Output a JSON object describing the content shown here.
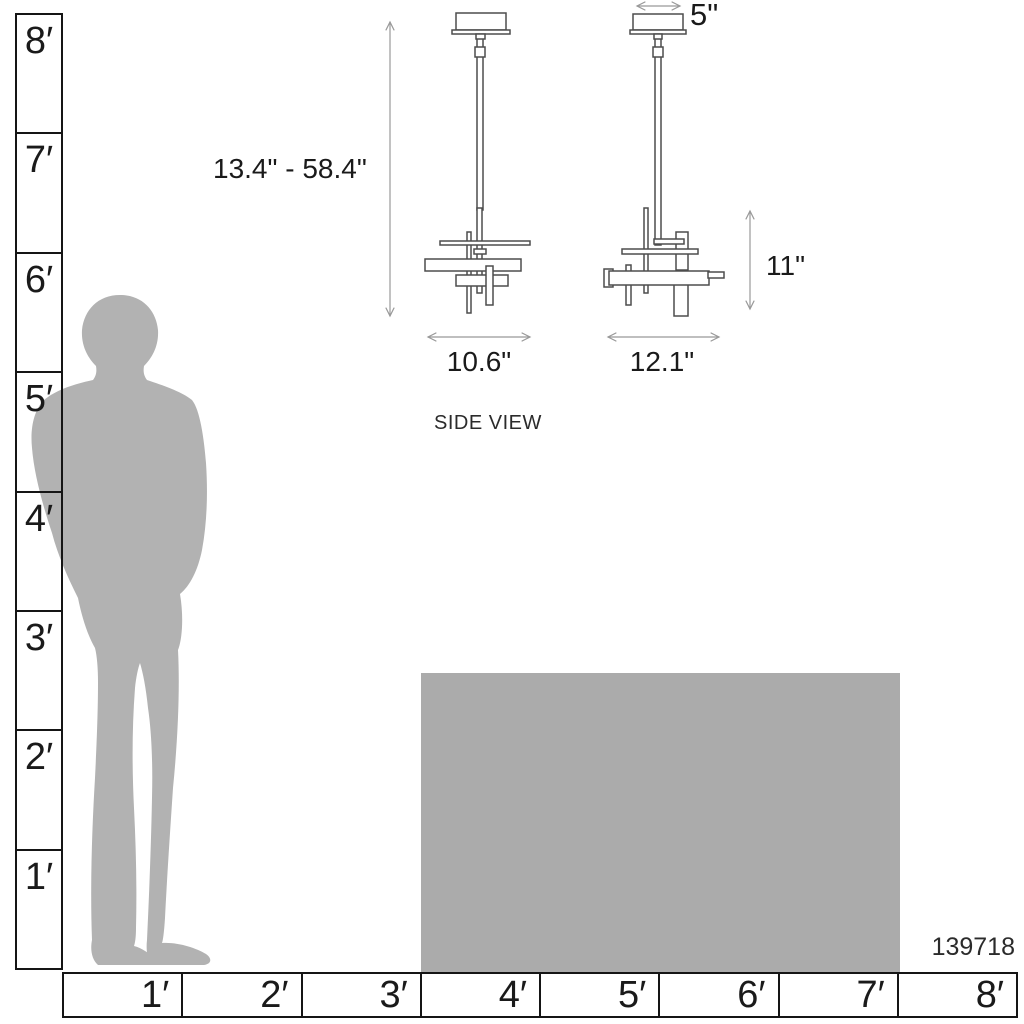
{
  "product_code": "139718",
  "view_labels": {
    "side_view": "SIDE VIEW"
  },
  "dimensions": {
    "height_range": "13.4\" - 58.4\"",
    "canopy_width": "5\"",
    "fixture_height": "11\"",
    "side_view_width": "10.6\"",
    "front_view_width": "12.1\""
  },
  "vertical_ruler": {
    "unit": "feet",
    "labels": [
      "8′",
      "7′",
      "6′",
      "5′",
      "4′",
      "3′",
      "2′",
      "1′"
    ]
  },
  "horizontal_ruler": {
    "unit": "feet",
    "labels": [
      "1′",
      "2′",
      "3′",
      "4′",
      "5′",
      "6′",
      "7′",
      "8′"
    ]
  },
  "figures": {
    "person": "human-silhouette-for-scale",
    "table": "table-height-reference-block",
    "left_drawing": "pendant-side-view",
    "right_drawing": "pendant-front-view"
  },
  "colors": {
    "silhouette": "#b2b2b2",
    "table": "#ababab",
    "ruler_line": "#151515",
    "drawing_stroke": "#4d4d4d",
    "dimension_arrow": "#999999",
    "text": "#1a1a1a"
  }
}
